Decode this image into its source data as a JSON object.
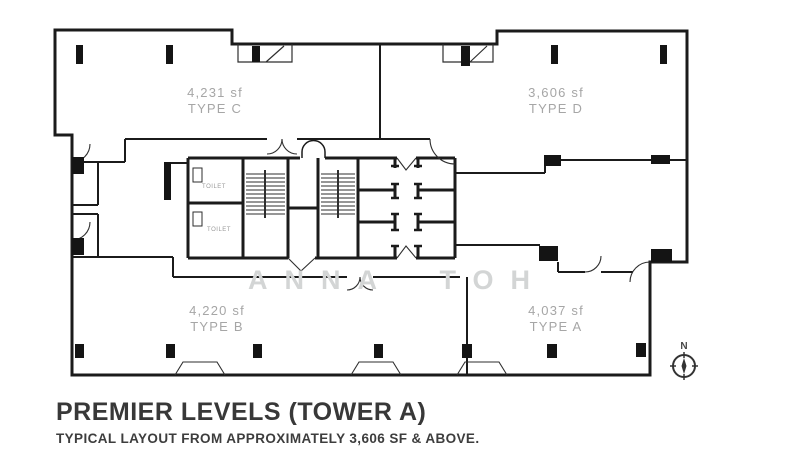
{
  "plan": {
    "watermark": "ANNA TOH",
    "compass_label": "N",
    "units": [
      {
        "sf": "4,231 sf",
        "type": "TYPE C"
      },
      {
        "sf": "3,606 sf",
        "type": "TYPE D"
      },
      {
        "sf": "4,220 sf",
        "type": "TYPE B"
      },
      {
        "sf": "4,037 sf",
        "type": "TYPE A"
      }
    ],
    "room_labels": {
      "toilet_upper": "TOILET",
      "toilet_lower": "TOILET"
    }
  },
  "caption": {
    "title": "PREMIER LEVELS (TOWER A)",
    "subtitle": "TYPICAL LAYOUT FROM APPROXIMATELY 3,606 SF & ABOVE."
  },
  "colors": {
    "wall": "#1b1b1b",
    "thin_line": "#2e2e2e",
    "unit_label": "#a6a6a6",
    "watermark": "#d3d5d5",
    "title": "#383838"
  }
}
